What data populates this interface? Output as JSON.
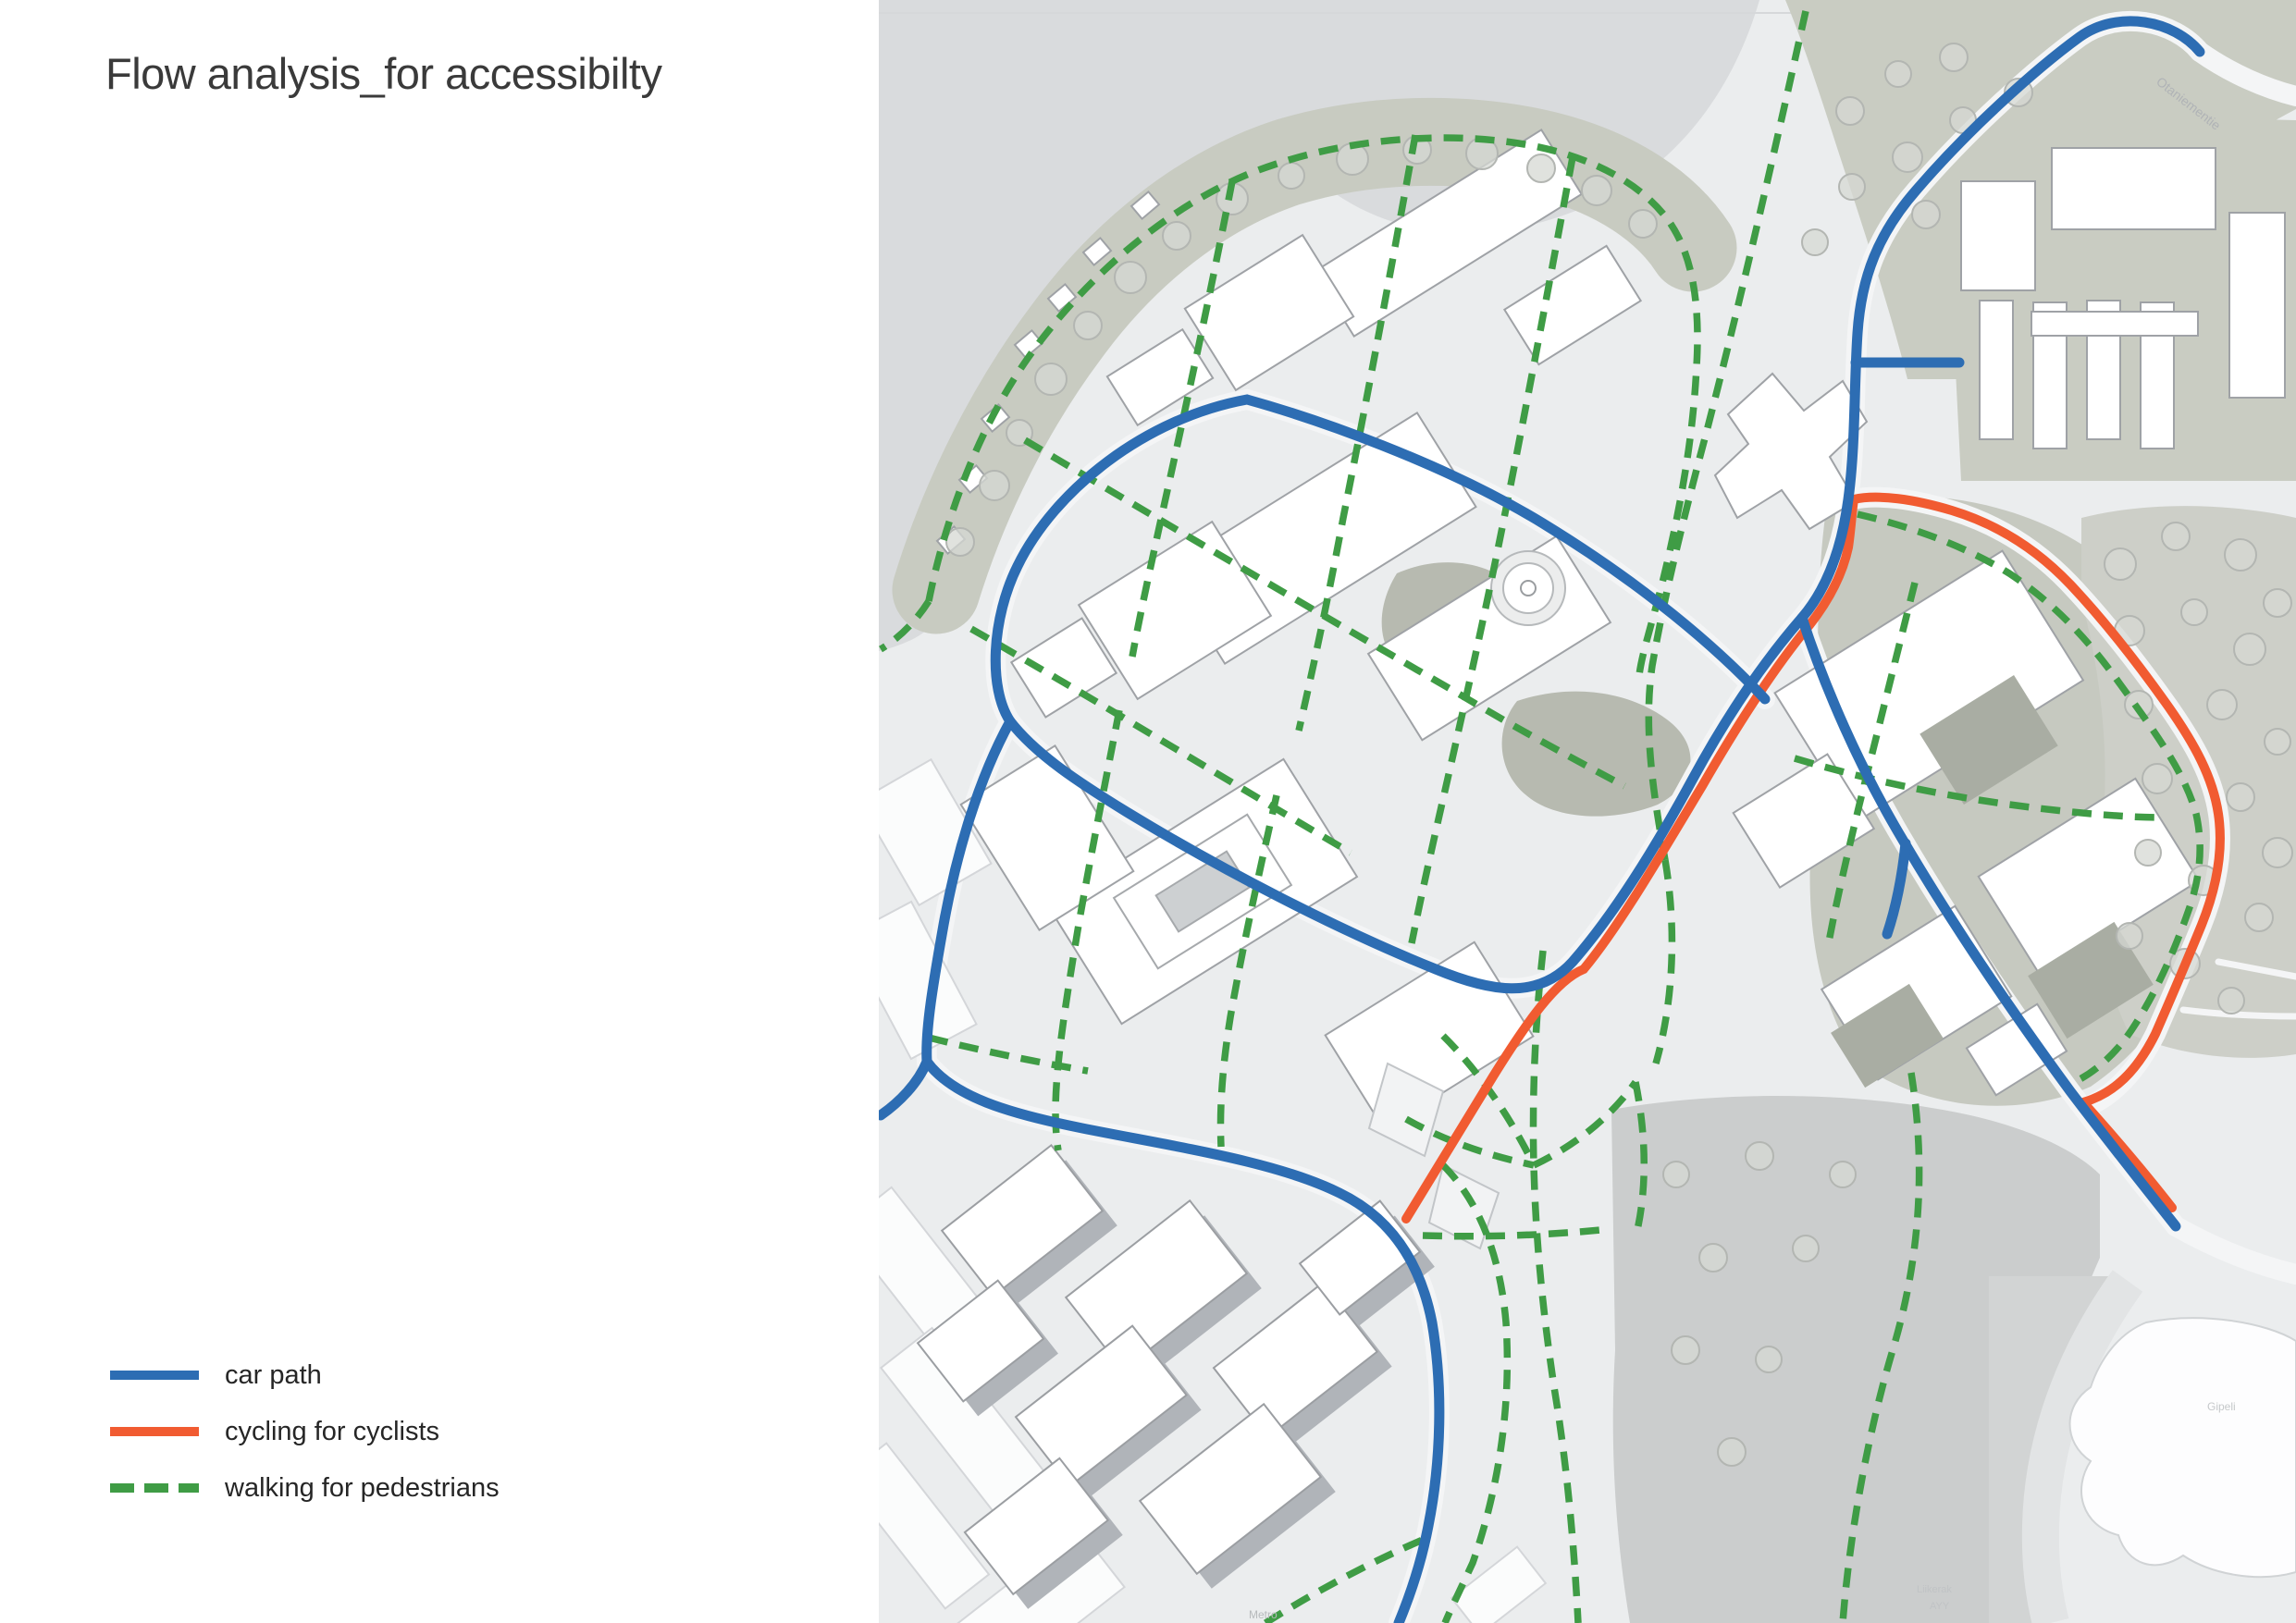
{
  "title": "Flow analysis_for accessibilty",
  "legend": {
    "items": [
      {
        "label": "car path",
        "color": "#2d6db3",
        "style": "solid"
      },
      {
        "label": "cycling for cyclists",
        "color": "#f15b31",
        "style": "solid"
      },
      {
        "label": "walking for pedestrians",
        "color": "#3f9c45",
        "style": "dashed"
      }
    ]
  },
  "map": {
    "labels": {
      "road": "Otaniementie",
      "metro": "Metro",
      "building_a": "Liikerak",
      "building_a2": "AYY",
      "building_b": "Gipeli"
    },
    "colors": {
      "car_path": "#2d6db3",
      "cycling_path": "#f15b31",
      "walking_path": "#3f9c45",
      "water": "#d9dbdd",
      "land": "#ebedee",
      "park": "#c8cbc1",
      "building": "#ffffff"
    }
  }
}
